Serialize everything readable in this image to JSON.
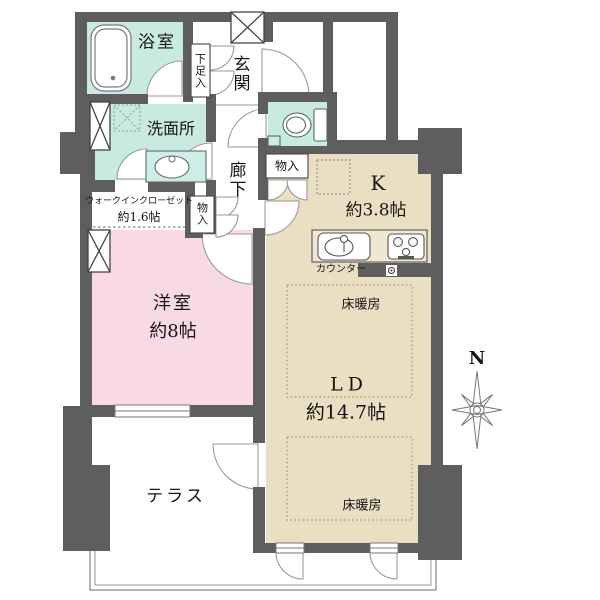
{
  "colors": {
    "wall": "#5e5e5e",
    "wet_area_floor": "#c9ebdf",
    "fixture_mint": "#cdeee4",
    "bedroom_floor": "#f9dae2",
    "living_floor": "#ebdfc3",
    "counter_fill": "#f0e7d2",
    "heating_dash": "#b49e74",
    "thin_line": "#999999"
  },
  "labels": {
    "bath": "浴室",
    "shoe_cabinet": "下足入",
    "entrance": "玄関",
    "washroom": "洗面所",
    "corridor": "廊下",
    "storage_top": "物入",
    "storage_left": "物入",
    "wic_name": "ウォークインクローゼット",
    "wic_size": "約1.6帖",
    "kitchen_name": "K",
    "kitchen_size": "約3.8帖",
    "counter": "カウンター",
    "heating_top": "床暖房",
    "heating_bottom": "床暖房",
    "living_name": "LD",
    "living_size": "約14.7帖",
    "bedroom_name": "洋室",
    "bedroom_size": "約8帖",
    "terrace": "テラス",
    "compass_north": "N"
  }
}
